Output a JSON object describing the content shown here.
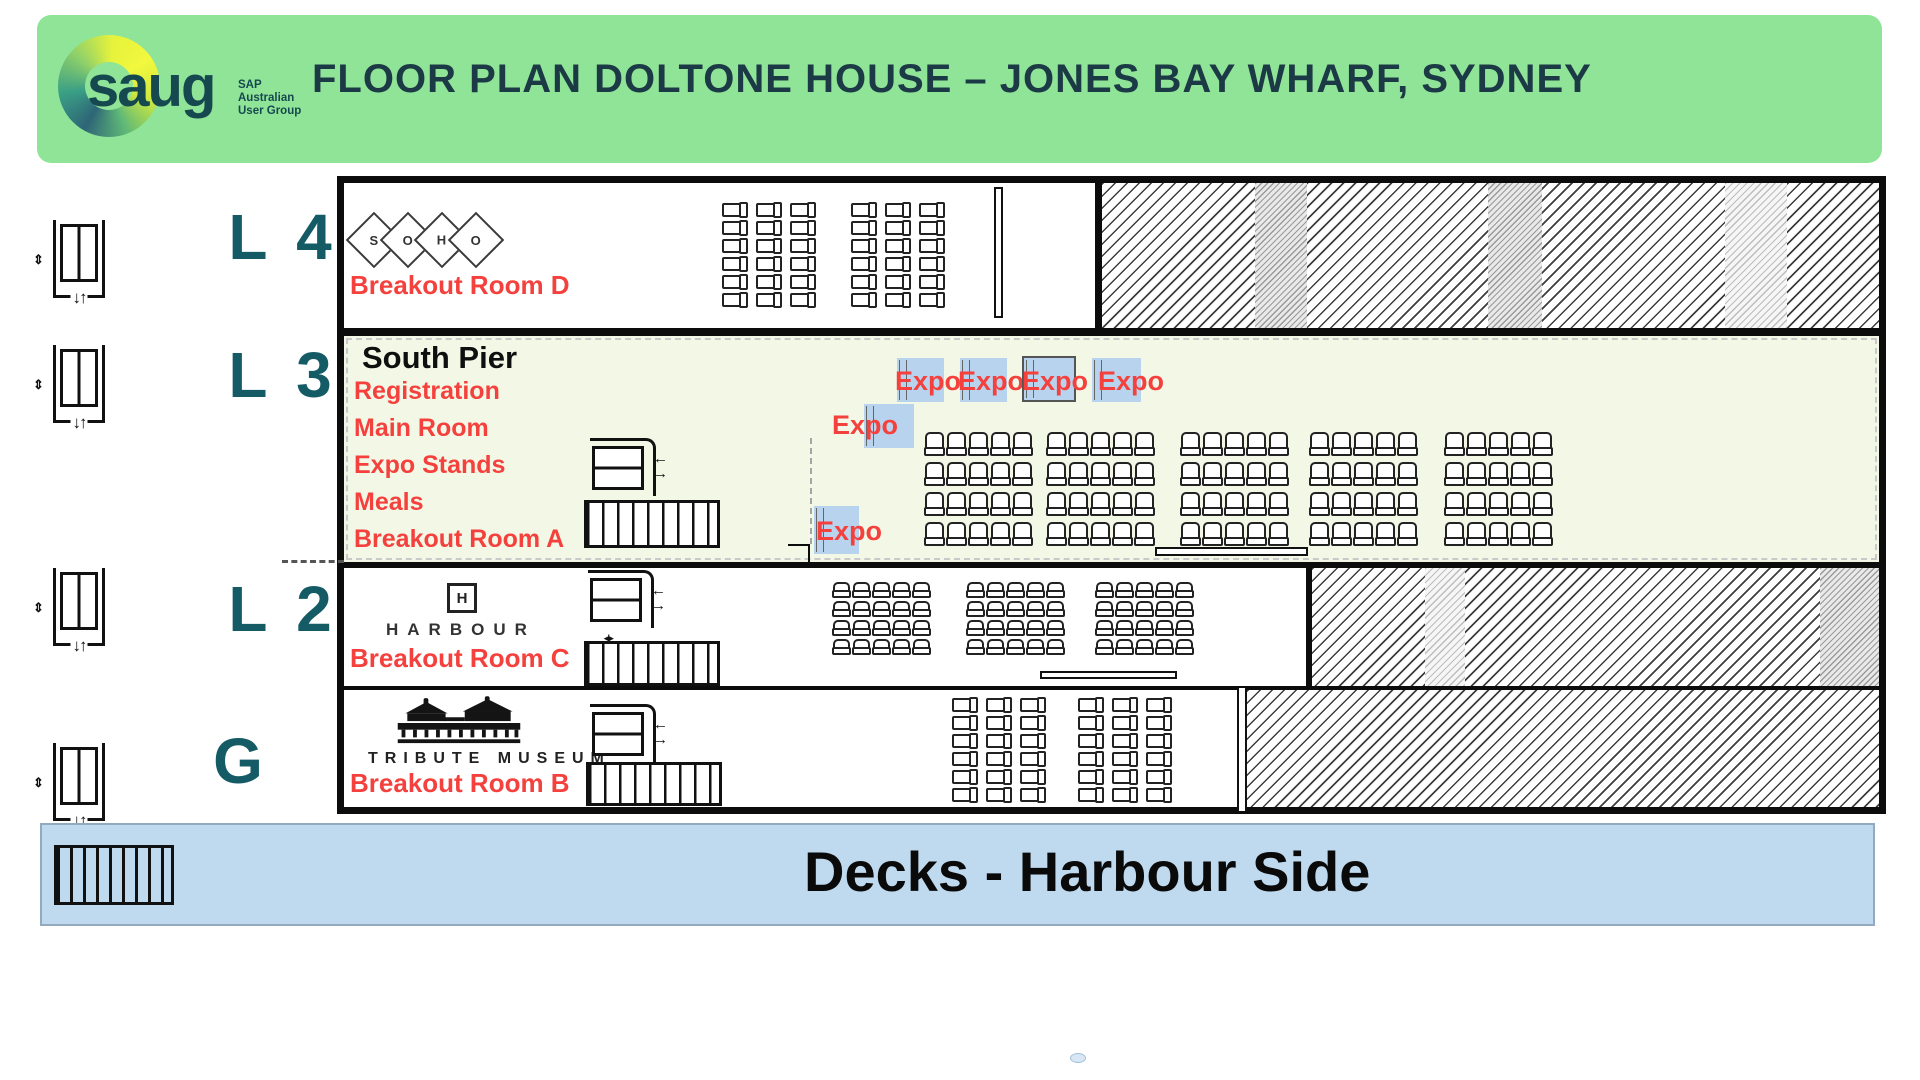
{
  "header": {
    "title": "FLOOR PLAN DOLTONE HOUSE – JONES BAY WHARF, SYDNEY",
    "logo": {
      "text": "saug",
      "sub": [
        "SAP",
        "Australian",
        "User Group"
      ]
    }
  },
  "levels": {
    "l4": {
      "label": "L 4",
      "venue_letters": [
        "S",
        "O",
        "H",
        "O"
      ],
      "room": "Breakout Room D"
    },
    "l3": {
      "label": "L 3",
      "venue": "South Pier",
      "functions": [
        "Registration",
        "Main Room",
        "Expo Stands",
        "Meals",
        "Breakout Room A"
      ]
    },
    "l2": {
      "label": "L 2",
      "venue": "HARBOUR",
      "venue_initial": "H",
      "room": "Breakout Room C"
    },
    "g": {
      "label": "G",
      "venue": "TRIBUTE MUSEUM",
      "room": "Breakout Room B"
    }
  },
  "expo": {
    "label": "Expo",
    "count": 6
  },
  "decks": {
    "label": "Decks - Harbour Side"
  },
  "icons": {
    "lift_updown": "↓↑",
    "lift_side": "⇕",
    "arrow_left": "←",
    "arrow_right": "→",
    "stairs_marker": "◂|▸"
  },
  "colors": {
    "banner_green": "#90e497",
    "header_text": "#1c3a45",
    "level_text": "#145b66",
    "accent_red": "#f5413d",
    "l3_background": "#f3f8e6",
    "expo_blue": "#b8d3ed",
    "decks_blue": "#bfd9ef"
  }
}
